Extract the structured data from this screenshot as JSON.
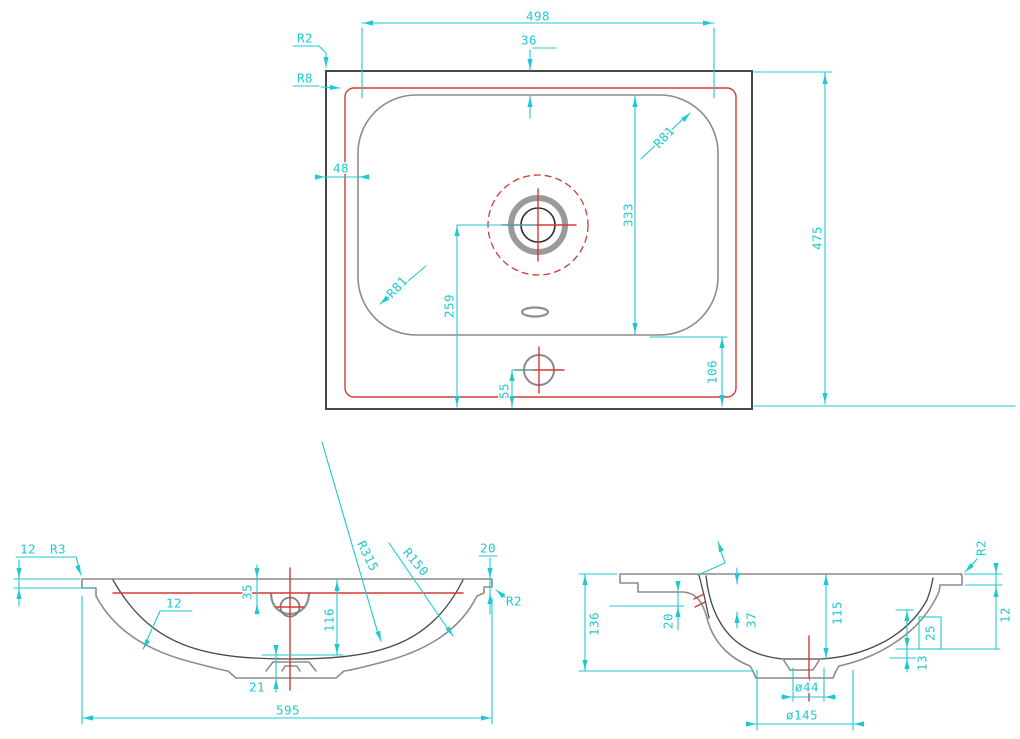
{
  "colors": {
    "dim": "#1ec9d2",
    "red": "#d23b32",
    "line": "#8c8c8c",
    "dark": "#474747",
    "bg": "#ffffff"
  },
  "views": {
    "top": {
      "name": "plan view of basin",
      "labels": {
        "width_498": "498",
        "offset_36": "36",
        "r2": "R2",
        "r8": "R8",
        "margin_48": "48",
        "r81_top_right": "R81",
        "r81_bottom_left": "R81",
        "height_333": "333",
        "dist_259": "259",
        "dist_55": "55",
        "dist_106": "106",
        "depth_475": "475"
      }
    },
    "front": {
      "name": "front section view",
      "labels": {
        "rim_12": "12",
        "r3": "R3",
        "wall_12": "12",
        "r315": "R315",
        "r150": "R150",
        "drop_20": "20",
        "r2": "R2",
        "water_35": "35",
        "depth_116": "116",
        "foot_21": "21",
        "width_595": "595"
      }
    },
    "side": {
      "name": "side section view",
      "labels": {
        "height_136": "136",
        "back_20": "20",
        "overflow_37": "37",
        "r2": "R2",
        "rim_12": "12",
        "depth_115": "115",
        "ref_25": "25",
        "step_13": "13",
        "drain_d44": "ø44",
        "recess_d145": "ø145"
      }
    }
  }
}
